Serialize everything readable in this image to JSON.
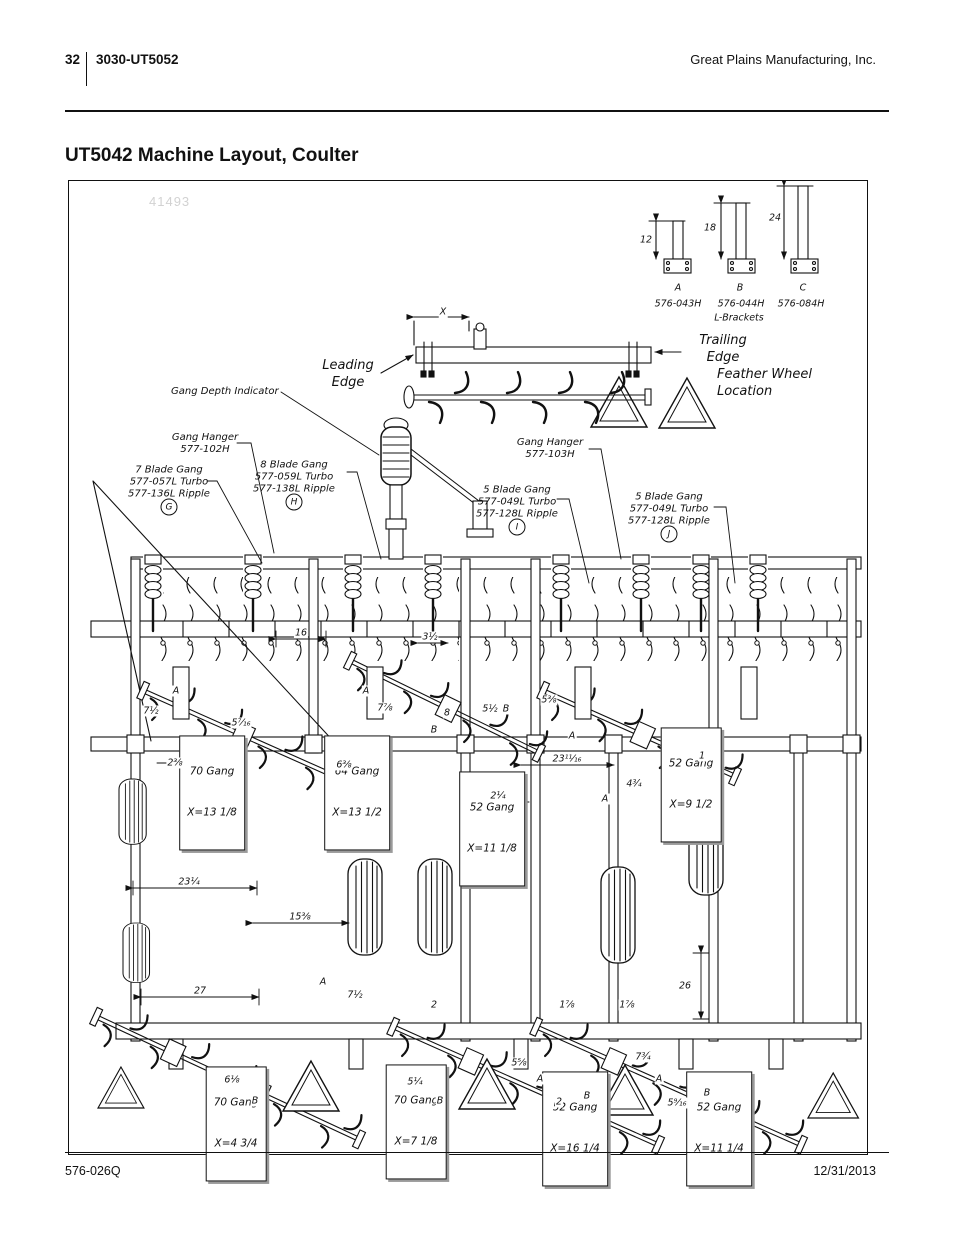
{
  "header": {
    "page_number": "32",
    "doc_id": "3030-UT5052",
    "company": "Great Plains Manufacturing, Inc."
  },
  "title": "UT5042 Machine Layout, Coulter",
  "footer": {
    "doc_code": "576-026Q",
    "date": "12/31/2013"
  },
  "figure": {
    "watermark": "41493",
    "labels": {
      "leading_edge": "Leading\nEdge",
      "trailing_edge": "Trailing\nEdge",
      "feather_wheel": "Feather Wheel\nLocation",
      "gang_depth_indicator": "Gang Depth Indicator",
      "gang_hanger_left": "Gang Hanger\n577-102H",
      "gang_hanger_right": "Gang Hanger\n577-103H",
      "blade_gang_7": "7 Blade Gang\n577-057L Turbo\n577-136L Ripple",
      "blade_gang_7_ref": "G",
      "blade_gang_8": "8 Blade Gang\n577-059L Turbo\n577-138L Ripple",
      "blade_gang_8_ref": "H",
      "blade_gang_5_left": "5 Blade Gang\n577-049L Turbo\n577-128L Ripple",
      "blade_gang_5_left_ref": "I",
      "blade_gang_5_right": "5 Blade Gang\n577-049L Turbo\n577-128L Ripple",
      "blade_gang_5_right_ref": "J"
    },
    "brackets": {
      "caption": "L-Brackets",
      "items": [
        {
          "letter": "A",
          "height": "12",
          "part": "576-043H"
        },
        {
          "letter": "B",
          "height": "18",
          "part": "576-044H"
        },
        {
          "letter": "C",
          "height": "24",
          "part": "576-084H"
        }
      ]
    },
    "gang_boxes": [
      {
        "name": "70 Gang",
        "x": "X=13 1/8"
      },
      {
        "name": "64 Gang",
        "x": "X=13 1/2"
      },
      {
        "name": "52 Gang",
        "x": "X=11 1/8"
      },
      {
        "name": "52 Gang",
        "x": "X=9 1/2"
      },
      {
        "name": "70 Gang",
        "x": "X=4 3/4"
      },
      {
        "name": "70 Gang",
        "x": "X=7 1/8"
      },
      {
        "name": "52 Gang",
        "x": "X=16 1/4"
      },
      {
        "name": "52 Gang",
        "x": "X=11 1/4"
      }
    ],
    "dims": [
      "X",
      "16",
      "3½",
      "A",
      "7½",
      "5⁷⁄₁₆",
      "A",
      "7⅞",
      "8",
      "B",
      "5½",
      "B",
      "5⅜",
      "A",
      "23¹¹⁄₁₆",
      "2¼",
      "2⅜",
      "6⅜",
      "1",
      "4¾",
      "A",
      "23¼",
      "15⅜",
      "27",
      "A",
      "7½",
      "2",
      "26",
      "1⅞",
      "1⅞",
      "6⅛",
      "B",
      "5¼",
      "B",
      "5⅝",
      "A",
      "2",
      "B",
      "7¾",
      "A",
      "5⁹⁄₁₆",
      "B"
    ]
  }
}
